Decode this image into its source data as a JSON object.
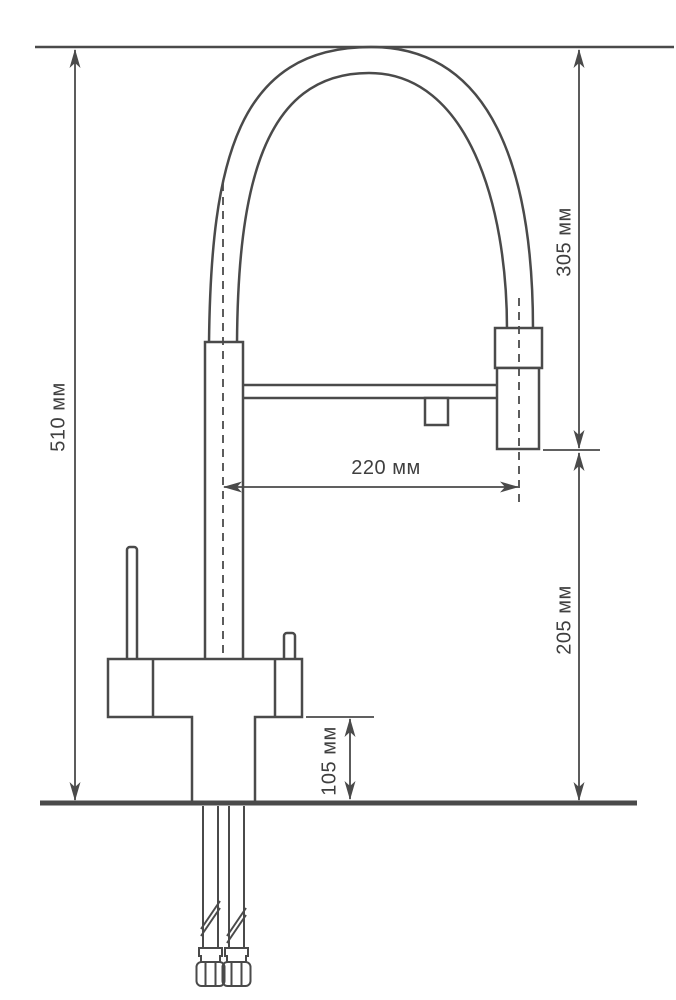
{
  "diagram": {
    "kind": "faucet-installation-dimensions",
    "unit": "мм",
    "colors": {
      "line": "#4a4a4a",
      "text": "#3f3f3f",
      "background": "#ffffff"
    },
    "dimensions": {
      "overall_height": {
        "value": 510,
        "label": "510 мм"
      },
      "top_to_spout_outlet": {
        "value": 305,
        "label": "305 мм"
      },
      "spout_outlet_to_counter": {
        "value": 205,
        "label": "205 мм"
      },
      "spout_reach": {
        "value": 220,
        "label": "220 мм"
      },
      "base_height": {
        "value": 105,
        "label": "105 мм"
      }
    }
  }
}
